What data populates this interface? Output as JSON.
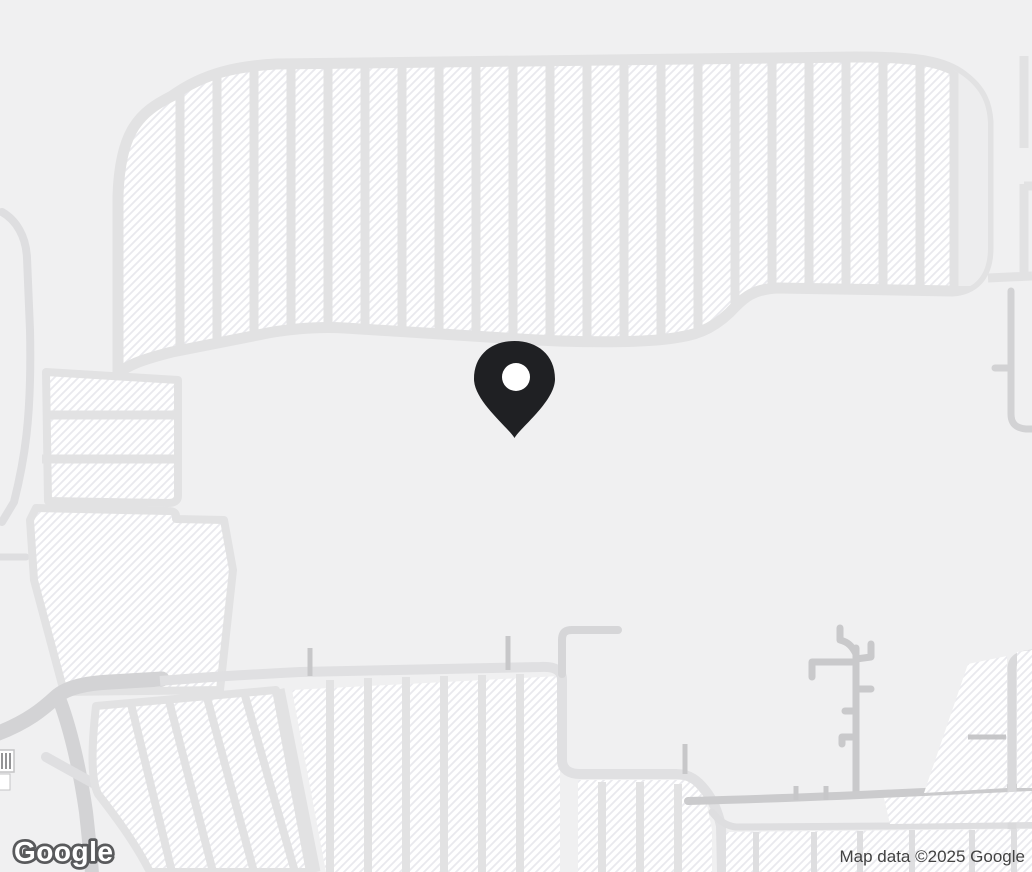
{
  "map": {
    "watermark": "Google",
    "attribution": "Map data ©2025 Google",
    "marker": {
      "icon": "location-pin-icon",
      "color": "#1f2023",
      "tip_position_px": {
        "x": 515,
        "y": 437
      }
    },
    "theme": {
      "background": "#f0f0f1",
      "parking_fill": "#ffffff",
      "parking_hatch_line": "#e9e9ee",
      "lot_divider_road": "#e2e2e3",
      "major_road": "#d3d3d5",
      "minor_road": "#c9c9cb",
      "logo_fill": "#ffffff",
      "logo_outline": "#595a5c",
      "attribution_text": "#424242"
    }
  }
}
